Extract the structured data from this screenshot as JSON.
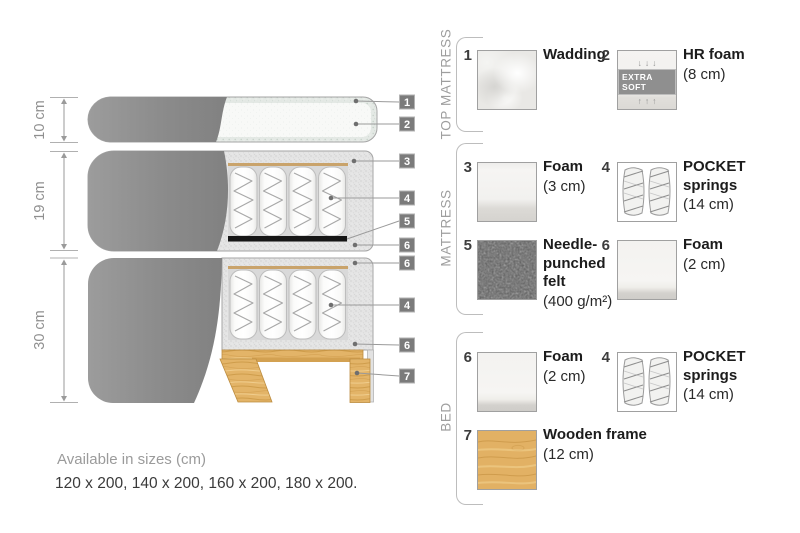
{
  "diagram": {
    "dimensions": [
      "10 cm",
      "19 cm",
      "30 cm"
    ],
    "tags": [
      "1",
      "2",
      "3",
      "4",
      "5",
      "6",
      "6",
      "4",
      "6",
      "7"
    ]
  },
  "legend": {
    "sections": [
      {
        "title": "TOP MATTRESS",
        "items": [
          {
            "num": "1",
            "name": "Wadding",
            "detail": ""
          },
          {
            "num": "2",
            "name": "HR foam",
            "detail": "(8 cm)",
            "badge": "EXTRA SOFT",
            "arrows_down": "↓↓↓",
            "arrows_up": "↑↑↑"
          }
        ]
      },
      {
        "title": "MATTRESS",
        "items": [
          {
            "num": "3",
            "name": "Foam",
            "detail": "(3 cm)"
          },
          {
            "num": "4",
            "name": "POCKET springs",
            "detail": "(14 cm)"
          },
          {
            "num": "5",
            "name": "Needle-punched felt",
            "detail": "(400 g/m²)"
          },
          {
            "num": "6",
            "name": "Foam",
            "detail": "(2 cm)"
          }
        ]
      },
      {
        "title": "BED",
        "items": [
          {
            "num": "6",
            "name": "Foam",
            "detail": "(2 cm)"
          },
          {
            "num": "4",
            "name": "POCKET springs",
            "detail": "(14 cm)"
          },
          {
            "num": "7",
            "name": "Wooden frame",
            "detail": "(12 cm)"
          }
        ]
      }
    ]
  },
  "footer": {
    "line1": "Available in sizes (cm)",
    "line2": "120 x 200, 140 x 200, 160 x 200, 180 x 200."
  },
  "colors": {
    "fabric_grey": "#8b8b8b",
    "casing_speckle": "#e4e4e4",
    "wood": "#e2b368",
    "tag_background": "#7b7b7b",
    "felt_dark": "#5d5d5d",
    "text_dark": "#1c1c1c",
    "text_grey": "#9b9b9b"
  }
}
